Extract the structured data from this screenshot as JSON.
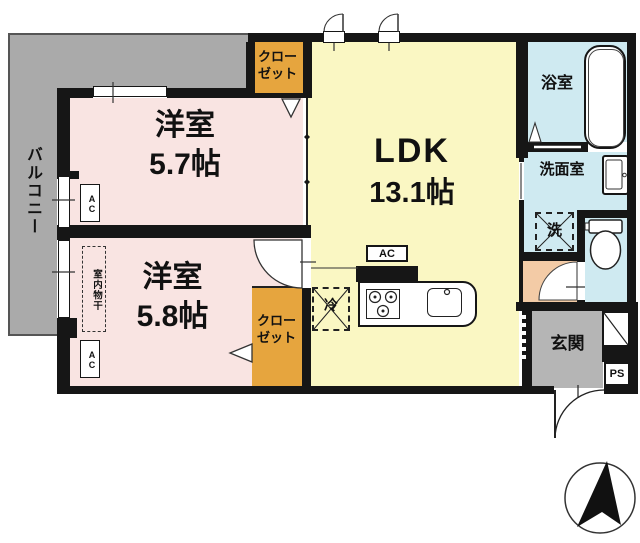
{
  "plan_title": "apartment-floor-plan",
  "labels": {
    "balcony": "バルコニー",
    "room1_name": "洋室",
    "room1_size": "5.7帖",
    "room2_name": "洋室",
    "room2_size": "5.8帖",
    "ldk_name": "LDK",
    "ldk_size": "13.1帖",
    "closet_line1": "クロー",
    "closet_line2": "ゼット",
    "bath": "浴室",
    "washroom": "洗面室",
    "laundry": "洗",
    "fridge": "冷",
    "entrance": "玄関",
    "ps": "PS",
    "ac": "AC",
    "indoor_drying": "室内物干"
  },
  "colors": {
    "wall": "#161616",
    "balcony_gray": "#aaaaaa",
    "room_pink": "#f9e4e2",
    "ldk_yellow": "#faf7c3",
    "closet_orange": "#e6a53e",
    "wet_area_blue": "#cfeaf1",
    "hall_peach": "#f3cba6",
    "entrance_gray": "#b5b5b5"
  }
}
